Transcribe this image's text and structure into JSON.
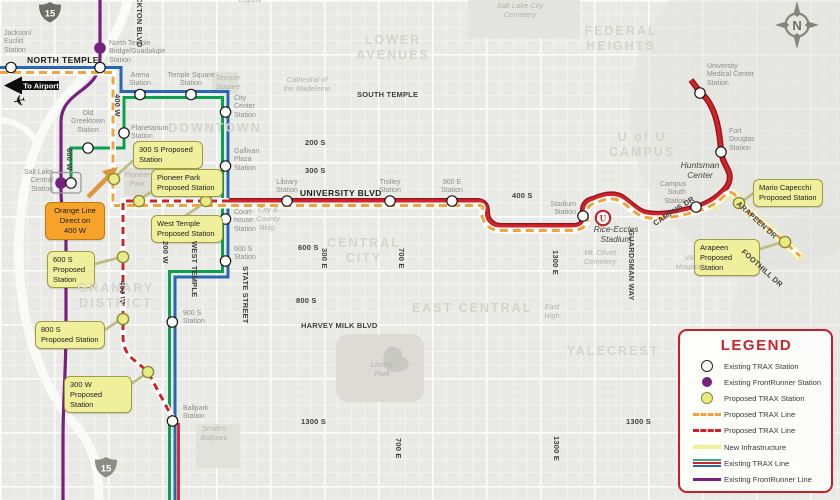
{
  "colors": {
    "trax_blue": "#2a67b1",
    "trax_green": "#0ba04f",
    "trax_red": "#cf2127",
    "trax_red_casing": "#8d1418",
    "frontrunner_purple": "#76217e",
    "proposed_orange": "#f2a43c",
    "proposed_station_fill": "#ebeb84",
    "proposed_station_border": "#8a8a35",
    "new_infrastructure": "#f1f1a2",
    "legend_border": "#c42127"
  },
  "compass": {
    "label": "N"
  },
  "airport": {
    "label": "To Airport",
    "plane_icon": "airplane"
  },
  "shields": [
    {
      "label": "15",
      "x": 50,
      "y": 12
    },
    {
      "label": "15",
      "x": 106,
      "y": 467
    }
  ],
  "stadium_logo": {
    "label": "U",
    "x": 603,
    "y": 218
  },
  "legend": {
    "title": "LEGEND",
    "items": [
      {
        "icon": "existing-trax-station-icon",
        "label": "Existing TRAX Station"
      },
      {
        "icon": "existing-frontrunner-station-icon",
        "label": "Existing FrontRunner Station"
      },
      {
        "icon": "proposed-trax-station-icon",
        "label": "Proposed TRAX Station"
      },
      {
        "icon": "proposed-trax-line-orange-icon",
        "label": "Proposed TRAX Line"
      },
      {
        "icon": "proposed-trax-line-red-icon",
        "label": "Proposed TRAX Line"
      },
      {
        "icon": "new-infrastructure-icon",
        "label": "New Infrastructure"
      },
      {
        "icon": "existing-trax-line-icon",
        "label": "Existing TRAX Line"
      },
      {
        "icon": "existing-frontrunner-line-icon",
        "label": "Existing FrontRunner Line"
      }
    ]
  },
  "orange_callout": {
    "lines": "Orange Line\nDirect on\n400 W",
    "x": 45,
    "y": 202,
    "w": 60
  },
  "stations": [
    {
      "name": "jackson-euclid",
      "type": "trax",
      "x": 11,
      "y": 67.5,
      "label": "Jackson/\nEuclid\nStation",
      "lx": 4,
      "ly": 30,
      "lw": 44,
      "align": "left"
    },
    {
      "name": "north-temple-bridge-guadalupe-frontrunner",
      "type": "frontrunner",
      "x": 100,
      "y": 48,
      "label": "",
      "lx": 0,
      "ly": 0,
      "lw": 0,
      "align": "left"
    },
    {
      "name": "north-temple-bridge-guadalupe",
      "type": "trax",
      "x": 100,
      "y": 67.5,
      "label": "North Temple\nBridge/Guadalupe\nStation",
      "lx": 109,
      "ly": 40,
      "lw": 84,
      "align": "left"
    },
    {
      "name": "arena",
      "type": "trax",
      "x": 140,
      "y": 94.5,
      "label": "Arena\nStation",
      "lx": 118,
      "ly": 72,
      "lw": 44,
      "align": "center"
    },
    {
      "name": "temple-square",
      "type": "trax",
      "x": 191,
      "y": 94.5,
      "label": "Temple Square\nStation",
      "lx": 160,
      "ly": 72,
      "lw": 62,
      "align": "center"
    },
    {
      "name": "city-center",
      "type": "trax",
      "x": 225.5,
      "y": 112,
      "label": "City\nCenter\nStation",
      "lx": 234,
      "ly": 95,
      "lw": 40,
      "align": "left"
    },
    {
      "name": "planetarium",
      "type": "trax",
      "x": 124,
      "y": 133,
      "label": "Planetarium\nStation",
      "lx": 131,
      "ly": 125,
      "lw": 52,
      "align": "left"
    },
    {
      "name": "old-greektown",
      "type": "trax",
      "x": 88,
      "y": 148,
      "label": "Old\nGreektown\nStation",
      "lx": 64,
      "ly": 110,
      "lw": 48,
      "align": "center"
    },
    {
      "name": "salt-lake-central-frontrunner",
      "type": "frontrunner",
      "x": 61,
      "y": 183,
      "label": "Salt Lake\nCentral\nStation",
      "lx": 15,
      "ly": 169,
      "lw": 38,
      "align": "right"
    },
    {
      "name": "salt-lake-central",
      "type": "trax",
      "x": 71,
      "y": 183,
      "label": "",
      "lx": 0,
      "ly": 0,
      "lw": 0,
      "align": "left"
    },
    {
      "name": "gallivan-plaza",
      "type": "trax",
      "x": 225.5,
      "y": 166,
      "label": "Gallivan\nPlaza\nStation",
      "lx": 234,
      "ly": 148,
      "lw": 40,
      "align": "left"
    },
    {
      "name": "library",
      "type": "trax",
      "x": 287,
      "y": 201,
      "label": "Library\nStation",
      "lx": 265,
      "ly": 179,
      "lw": 44,
      "align": "center"
    },
    {
      "name": "courthouse",
      "type": "trax",
      "x": 225.5,
      "y": 219,
      "label": "Court-\nhouse\nStation",
      "lx": 234,
      "ly": 209,
      "lw": 40,
      "align": "left"
    },
    {
      "name": "trolley",
      "type": "trax",
      "x": 390,
      "y": 201,
      "label": "Trolley\nStation",
      "lx": 368,
      "ly": 179,
      "lw": 44,
      "align": "center"
    },
    {
      "name": "900-e",
      "type": "trax",
      "x": 452,
      "y": 201,
      "label": "900 E\nStation",
      "lx": 430,
      "ly": 179,
      "lw": 44,
      "align": "center"
    },
    {
      "name": "stadium",
      "type": "trax",
      "x": 583,
      "y": 216,
      "label": "Stadium\nStation",
      "lx": 536,
      "ly": 201,
      "lw": 40,
      "align": "right"
    },
    {
      "name": "600-s",
      "type": "trax",
      "x": 225.5,
      "y": 261,
      "label": "600 S\nStation",
      "lx": 234,
      "ly": 246,
      "lw": 40,
      "align": "left"
    },
    {
      "name": "900-s",
      "type": "trax",
      "x": 172.3,
      "y": 322,
      "label": "900 S\nStation",
      "lx": 183,
      "ly": 310,
      "lw": 40,
      "align": "left"
    },
    {
      "name": "ballpark",
      "type": "trax",
      "x": 172.5,
      "y": 421,
      "label": "Ballpark\nStation",
      "lx": 183,
      "ly": 405,
      "lw": 44,
      "align": "left"
    },
    {
      "name": "fort-douglas",
      "type": "trax",
      "x": 721,
      "y": 152,
      "label": "Fort\nDouglas\nStation",
      "lx": 729,
      "ly": 128,
      "lw": 44,
      "align": "left"
    },
    {
      "name": "campus-south",
      "type": "trax",
      "x": 696,
      "y": 207,
      "label": "Campus\nSouth\nStation",
      "lx": 646,
      "ly": 181,
      "lw": 40,
      "align": "right"
    },
    {
      "name": "university-medical-center",
      "type": "trax",
      "x": 700,
      "y": 93,
      "label": "University\nMedical Center\nStation",
      "lx": 707,
      "ly": 63,
      "lw": 64,
      "align": "left"
    }
  ],
  "proposed_stations": [
    {
      "name": "300-s-proposed",
      "lines": "300 S Proposed\nStation",
      "bx": 133,
      "by": 141,
      "bw": 70,
      "cx": 114,
      "cy": 179,
      "k": [
        137,
        157,
        114,
        178
      ]
    },
    {
      "name": "pioneer-park-proposed",
      "lines": "Pioneer Park\nProposed Station",
      "bx": 151,
      "by": 169,
      "bw": 72,
      "cx": 139,
      "cy": 201,
      "k": [
        157,
        188,
        139,
        200
      ]
    },
    {
      "name": "west-temple-proposed",
      "lines": "West Temple\nProposed Station",
      "bx": 151,
      "by": 215,
      "bw": 72,
      "cx": 206,
      "cy": 201,
      "k": [
        185,
        216,
        206,
        202
      ]
    },
    {
      "name": "600-s-proposed",
      "lines": "600 S\nProposed\nStation",
      "bx": 47,
      "by": 251,
      "bw": 48,
      "cx": 123,
      "cy": 257,
      "k": [
        95,
        264,
        121,
        257
      ]
    },
    {
      "name": "800-s-proposed",
      "lines": "800 S\nProposed Station",
      "bx": 35,
      "by": 321,
      "bw": 70,
      "cx": 123,
      "cy": 319,
      "k": [
        105,
        330,
        121,
        319
      ]
    },
    {
      "name": "300-w-proposed",
      "lines": "300 W\nProposed Station",
      "bx": 64,
      "by": 376,
      "bw": 68,
      "cx": 148,
      "cy": 372,
      "k": [
        131,
        384,
        147,
        373
      ]
    },
    {
      "name": "mario-capecchi-proposed",
      "lines": "Mario Capecchi\nProposed Station",
      "bx": 753,
      "by": 179,
      "bw": 70,
      "cx": 739,
      "cy": 203,
      "k": [
        755,
        192,
        740,
        203
      ]
    },
    {
      "name": "arapeen-proposed",
      "lines": "Arapeen\nProposed Station",
      "bx": 694,
      "by": 239,
      "bw": 66,
      "cx": 785,
      "cy": 242,
      "k": [
        760,
        249,
        783,
        242
      ]
    }
  ],
  "streets": [
    {
      "t": "NORTH TEMPLE",
      "x": 27,
      "y": 55,
      "kind": "big"
    },
    {
      "t": "SOUTH TEMPLE",
      "x": 357,
      "y": 91,
      "kind": "h"
    },
    {
      "t": "UNIVERSITY BLVD",
      "x": 300,
      "y": 188,
      "kind": "big"
    },
    {
      "t": "400 S",
      "x": 512,
      "y": 192,
      "kind": "h"
    },
    {
      "t": "200 S",
      "x": 305,
      "y": 139,
      "kind": "h"
    },
    {
      "t": "300 S",
      "x": 305,
      "y": 167,
      "kind": "h"
    },
    {
      "t": "600 S",
      "x": 298,
      "y": 244,
      "kind": "h"
    },
    {
      "t": "800 S",
      "x": 296,
      "y": 297,
      "kind": "h"
    },
    {
      "t": "HARVEY MILK BLVD",
      "x": 301,
      "y": 322,
      "kind": "h"
    },
    {
      "t": "1300 S",
      "x": 301,
      "y": 418,
      "kind": "h"
    },
    {
      "t": "1300 S",
      "x": 626,
      "y": 418,
      "kind": "h"
    },
    {
      "t": "CKTON BLVD",
      "x": 134,
      "y": -3,
      "kind": "v"
    },
    {
      "t": "400 W",
      "x": 112,
      "y": 94,
      "kind": "v"
    },
    {
      "t": "600 W",
      "x": 64,
      "y": 148,
      "kind": "v"
    },
    {
      "t": "200 W",
      "x": 160,
      "y": 241,
      "kind": "v"
    },
    {
      "t": "WEST TEMPLE",
      "x": 189,
      "y": 241,
      "kind": "v"
    },
    {
      "t": "STATE STREET",
      "x": 240,
      "y": 266,
      "kind": "v"
    },
    {
      "t": "400 W",
      "x": 117,
      "y": 281,
      "kind": "v"
    },
    {
      "t": "300 E",
      "x": 319,
      "y": 248,
      "kind": "v"
    },
    {
      "t": "700 E",
      "x": 396,
      "y": 248,
      "kind": "v"
    },
    {
      "t": "700 E",
      "x": 393,
      "y": 438,
      "kind": "v"
    },
    {
      "t": "1300 E",
      "x": 550,
      "y": 250,
      "kind": "v"
    },
    {
      "t": "1300 E",
      "x": 551,
      "y": 436,
      "kind": "v"
    },
    {
      "t": "GUARDSMAN WAY",
      "x": 626,
      "y": 230,
      "kind": "v"
    },
    {
      "t": "CAMPUS DR",
      "x": 652,
      "y": 221,
      "kind": "a",
      "angle": -33
    },
    {
      "t": "ARAPEEN DR",
      "x": 740,
      "y": 200,
      "kind": "a",
      "angle": 42
    },
    {
      "t": "FOOTHILL DR",
      "x": 745,
      "y": 248,
      "kind": "a",
      "angle": 42
    }
  ],
  "districts": [
    {
      "t": "LOWER\nAVENUES",
      "x": 393,
      "y": 33
    },
    {
      "t": "FEDERAL\nHEIGHTS",
      "x": 621,
      "y": 24
    },
    {
      "t": "U of U\nCAMPUS",
      "x": 642,
      "y": 130
    },
    {
      "t": "DOWNTOWN",
      "x": 215,
      "y": 121
    },
    {
      "t": "CENTRAL\nCITY",
      "x": 364,
      "y": 236
    },
    {
      "t": "EAST CENTRAL",
      "x": 472,
      "y": 301
    },
    {
      "t": "GRANARY\nDISTRICT",
      "x": 116,
      "y": 281
    },
    {
      "t": "YALECREST",
      "x": 613,
      "y": 344
    }
  ],
  "landmarks": [
    {
      "t": "Salt Lake City\nCemetery",
      "x": 520,
      "y": 2,
      "dark": false
    },
    {
      "t": "Capitol",
      "x": 250,
      "y": -4,
      "dark": false
    },
    {
      "t": "Cathedral of\nthe Madeleine",
      "x": 307,
      "y": 76,
      "dark": false
    },
    {
      "t": "Temple\nSquare",
      "x": 228,
      "y": 74,
      "dark": false
    },
    {
      "t": "City &\nCounty\nBldg.",
      "x": 268,
      "y": 206,
      "dark": false
    },
    {
      "t": "Pioneer\nPark",
      "x": 137,
      "y": 171,
      "dark": false
    },
    {
      "t": "Huntsman\nCenter",
      "x": 700,
      "y": 160,
      "dark": true
    },
    {
      "t": "Rice-Eccles\nStadium",
      "x": 616,
      "y": 224,
      "dark": true
    },
    {
      "t": "Mt. Olivet\nCemetery",
      "x": 600,
      "y": 249,
      "dark": false
    },
    {
      "t": "East\nHigh",
      "x": 552,
      "y": 303,
      "dark": false
    },
    {
      "t": "Liberty\nPark",
      "x": 382,
      "y": 361,
      "dark": false
    },
    {
      "t": "Smith's\nBallpark",
      "x": 214,
      "y": 425,
      "dark": false
    },
    {
      "t": "VA\nHospital",
      "x": 689,
      "y": 254,
      "dark": false
    }
  ]
}
